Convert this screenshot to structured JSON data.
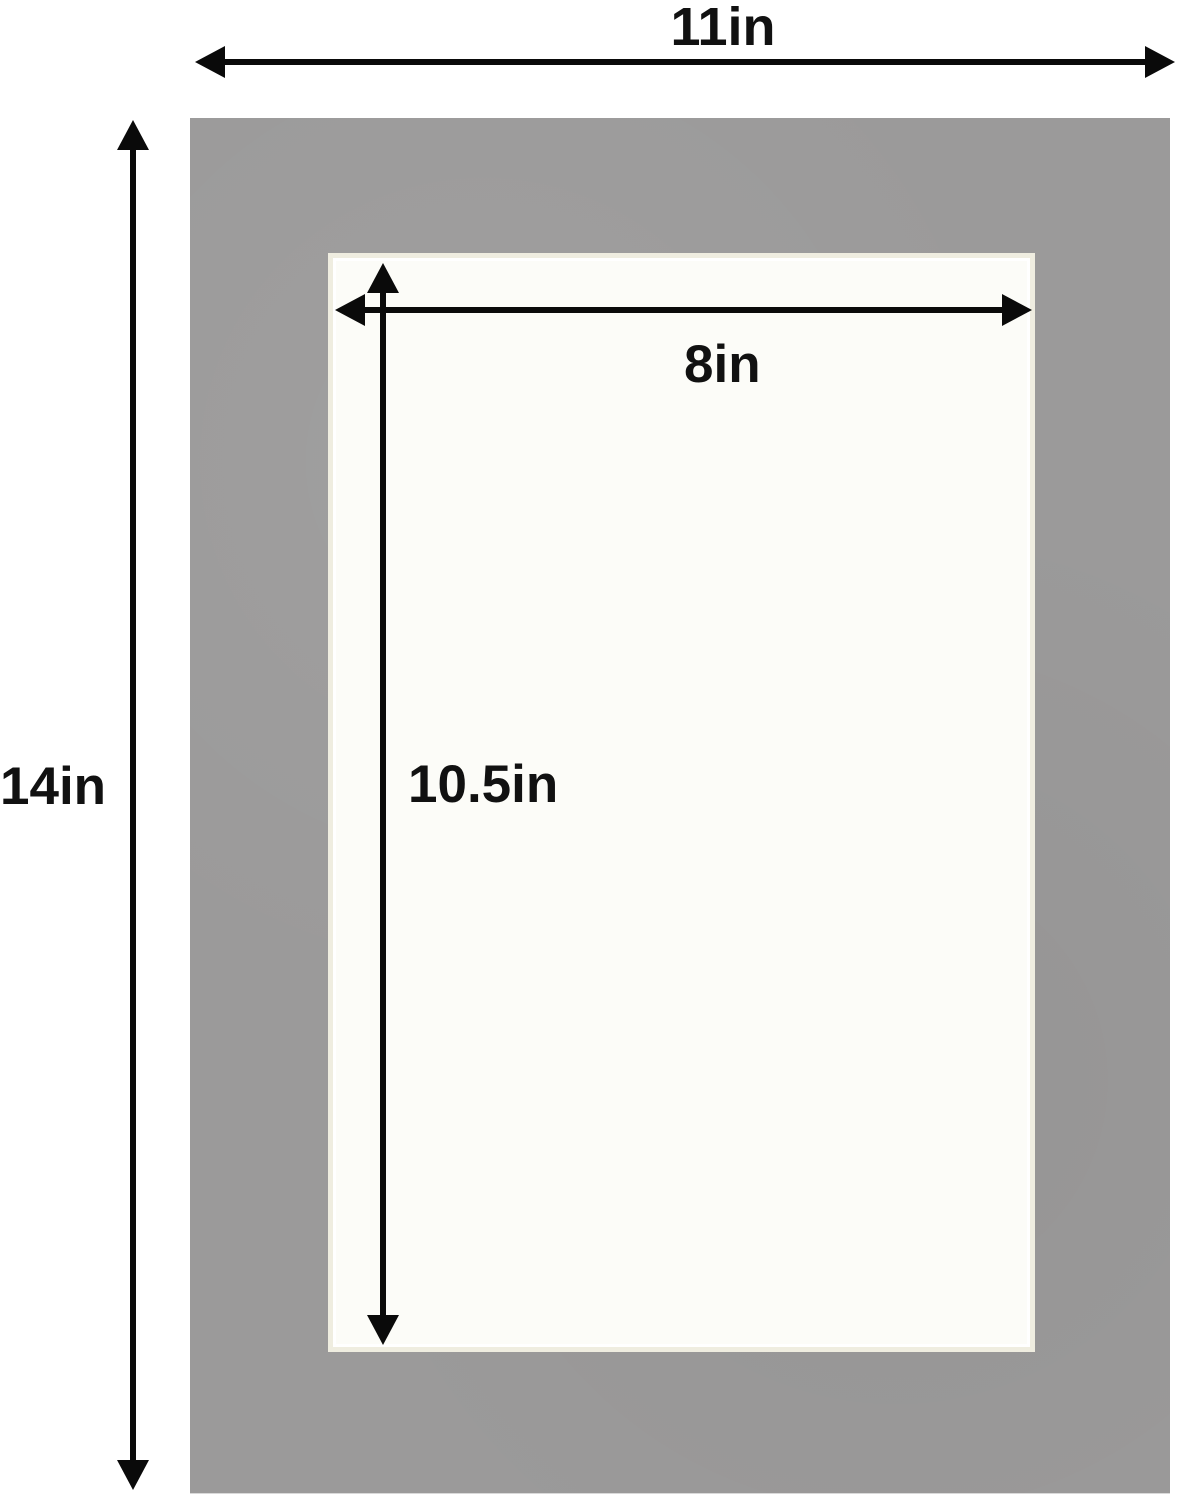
{
  "diagram": {
    "type": "picture-mat-dimension-diagram",
    "mat": {
      "color": "#9b9a9a",
      "outer_width_label": "11in",
      "outer_height_label": "14in"
    },
    "opening": {
      "color": "#fcfcf8",
      "bevel_color": "#efede0",
      "width_label": "8in",
      "height_label": "10.5in"
    },
    "arrow_color": "#0a0a0a",
    "background_color": "#ffffff"
  }
}
